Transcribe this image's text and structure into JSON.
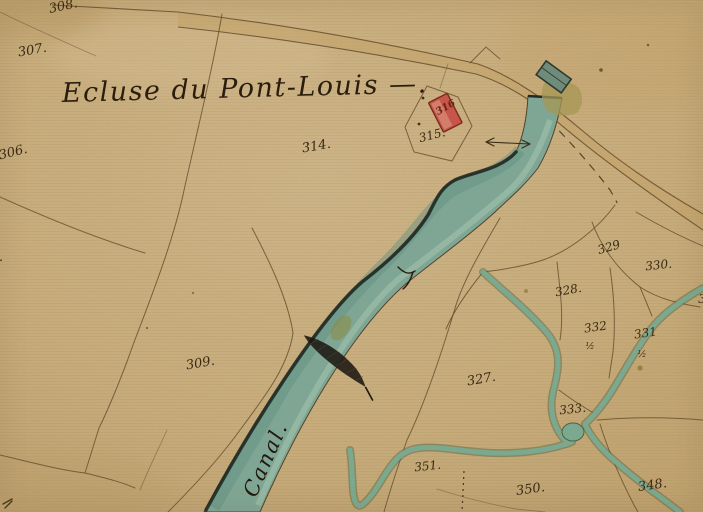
{
  "map": {
    "title": "Ecluse du Pont-Louis —.",
    "canal_label": "Canal.",
    "parcel_labels": [
      {
        "id": "p308",
        "label": "308."
      },
      {
        "id": "p307",
        "label": "307."
      },
      {
        "id": "p306",
        "label": "306."
      },
      {
        "id": "p305",
        "label": "305."
      },
      {
        "id": "p314",
        "label": "314."
      },
      {
        "id": "p315",
        "label": "315."
      },
      {
        "id": "b316",
        "label": "316"
      },
      {
        "id": "p309",
        "label": "309."
      },
      {
        "id": "p327",
        "label": "327."
      },
      {
        "id": "p329",
        "label": "329"
      },
      {
        "id": "p330",
        "label": "330."
      },
      {
        "id": "p328",
        "label": "328."
      },
      {
        "id": "p332",
        "label": "332",
        "fraction": "½"
      },
      {
        "id": "p331",
        "label": "331",
        "fraction": "½"
      },
      {
        "id": "p333",
        "label": "333."
      },
      {
        "id": "p351",
        "label": "351."
      },
      {
        "id": "p350",
        "label": "350."
      },
      {
        "id": "p348",
        "label": "348."
      },
      {
        "id": "p334_partial",
        "label": "3"
      }
    ],
    "colors": {
      "paper": "#c9ad7c",
      "paper_light": "#d2ba8e",
      "road": "#c2a268",
      "canal": "#7fa694",
      "canal_dark_edge": "#1f2a24",
      "stream": "#7ba98f",
      "building": "#c7564a",
      "building_outline": "#7c2a1d",
      "lock": "#6e8c79",
      "olive_patch": "#a69754",
      "ink": "#3a2a14",
      "boundary_line": "#6a5230"
    }
  }
}
